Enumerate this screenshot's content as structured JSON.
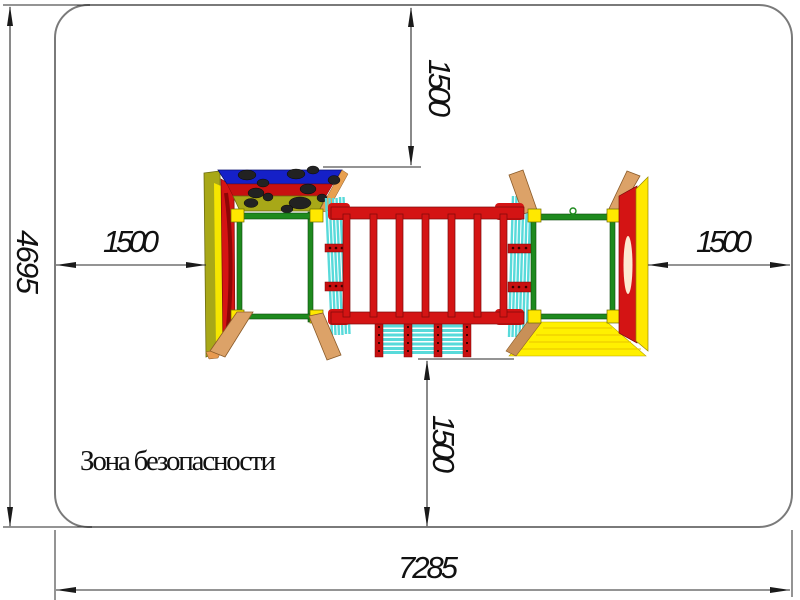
{
  "drawing": {
    "safety_zone_label": "Зона безопасности",
    "dims": {
      "overall_height": "4695",
      "overall_width": "7285",
      "clearance_top": "1500",
      "clearance_bottom": "1500",
      "clearance_left": "1500",
      "clearance_right": "1500"
    },
    "colors": {
      "boundary_gray": "#7a7a7a",
      "dimension_black": "#1a1a1a",
      "equipment_red": "#d41414",
      "equipment_green": "#1e8a1e",
      "equipment_yellow": "#ffe800",
      "roof_blue": "#1520c8",
      "wall_olive": "#a8a818",
      "slat_cyan": "#58dada",
      "wood_tan": "#dca268",
      "grip_black": "#222222"
    }
  }
}
